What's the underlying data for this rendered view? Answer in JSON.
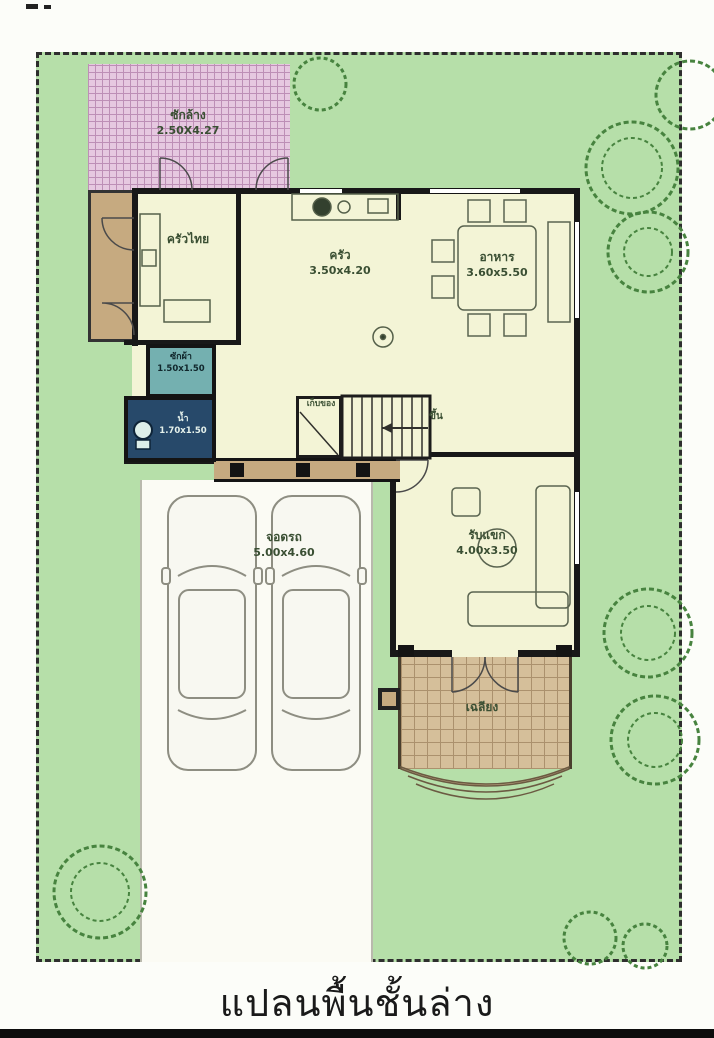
{
  "caption": {
    "title": "แปลนพื้นชั้นล่าง"
  },
  "rooms": {
    "wash": {
      "name": "ซักล้าง",
      "dim": "2.50X4.27"
    },
    "thai_kitchen": {
      "name": "ครัวไทย"
    },
    "kitchen": {
      "name": "ครัว",
      "dim": "3.50x4.20"
    },
    "dining": {
      "name": "อาหาร",
      "dim": "3.60x5.50"
    },
    "laundry": {
      "name": "ซักผ้า",
      "dim": "1.50x1.50"
    },
    "bath": {
      "name": "น้ำ",
      "dim": "1.70x1.50"
    },
    "storage": {
      "name": "เก็บของ"
    },
    "stairs": {
      "up_label": "ขึ้น"
    },
    "living": {
      "name": "รับแขก",
      "dim": "4.00x3.50"
    },
    "carport": {
      "name": "จอดรถ",
      "dim": "5.00x4.60"
    },
    "porch": {
      "name": "เฉลียง"
    }
  },
  "colors": {
    "lawn": "#b6dfa9",
    "tree_line": "#47833f",
    "wash_pink": "#e6c8e0",
    "floor_cream": "#f3f4d6",
    "terrace_tan": "#c6aa80",
    "porch_tan": "#d5bf9a",
    "laundry_teal": "#74b0b0",
    "bath_navy": "#27496a",
    "wall_black": "#181818",
    "label_green": "#3a4f33"
  }
}
